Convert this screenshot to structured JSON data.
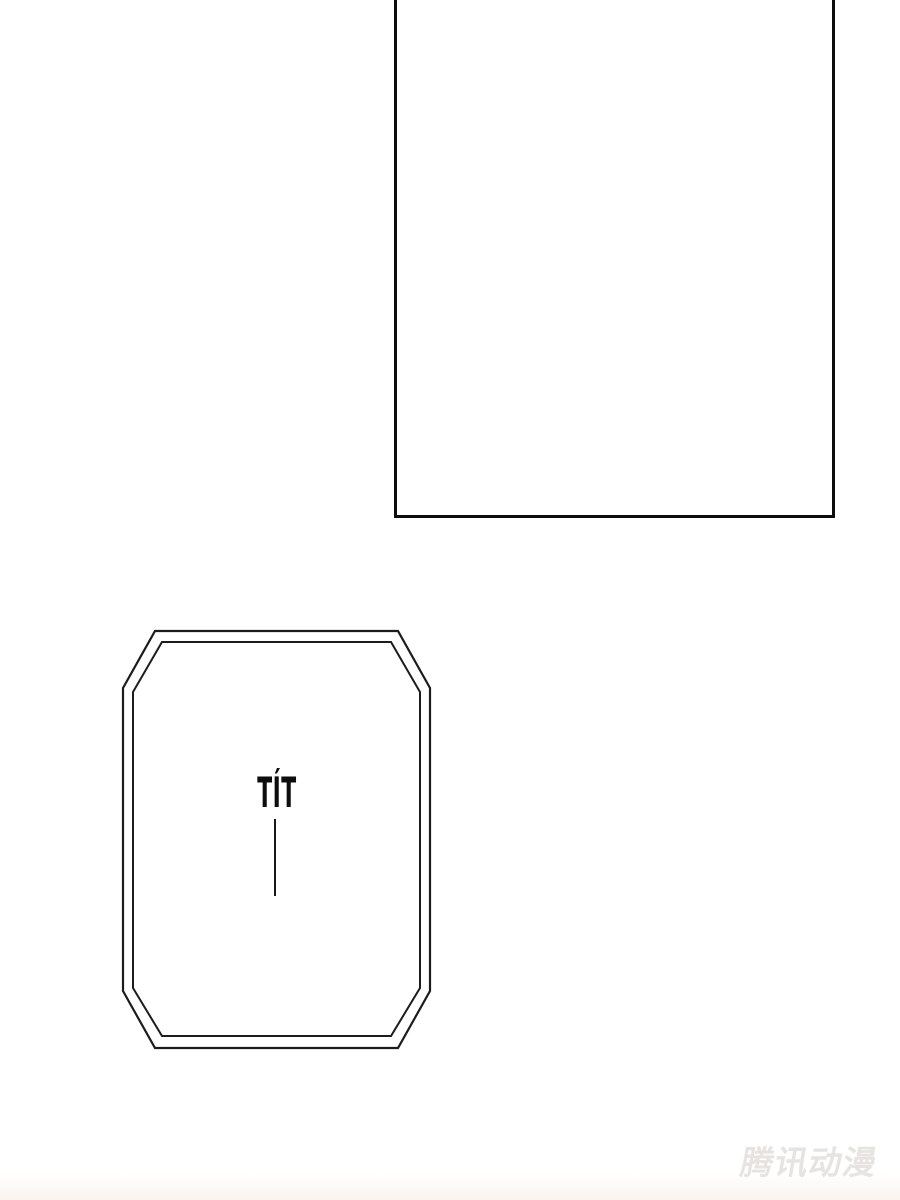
{
  "page": {
    "kind": "comic-page",
    "background_color": "#ffffff",
    "line_color": "#141414"
  },
  "panels": [
    {
      "id": "top-panel",
      "shape": "rectangle",
      "content": ""
    },
    {
      "id": "octagon-panel",
      "shape": "octagon-double-border",
      "content": "TÍT"
    }
  ],
  "sfx": {
    "text": "TÍT",
    "color": "#0d0d0d"
  },
  "watermark": {
    "text": "腾讯动漫",
    "color": "#e7e3e0"
  }
}
